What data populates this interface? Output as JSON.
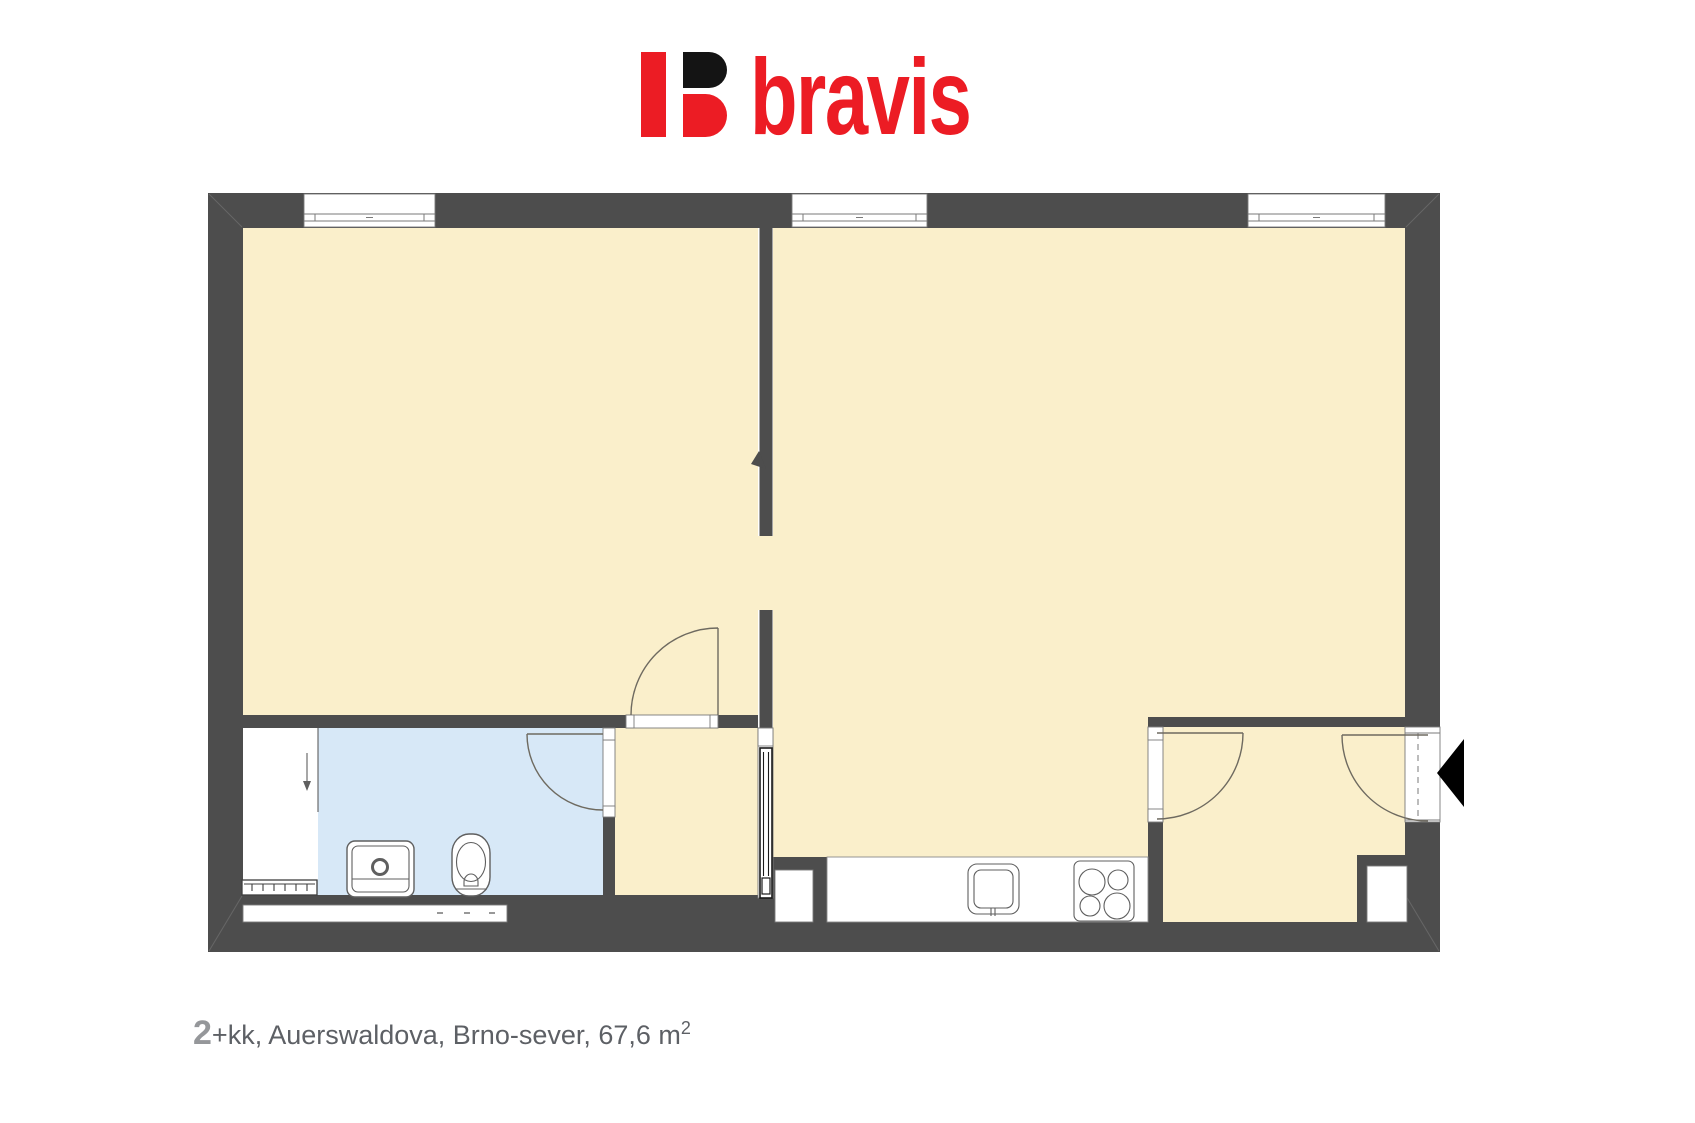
{
  "brand": {
    "name": "bravis"
  },
  "caption": {
    "number": "2",
    "rest": "+kk, Auerswaldova, Brno-sever, 67,6 m",
    "superscript": "2"
  },
  "colors": {
    "logo_red": "#ec1c24",
    "logo_black": "#141414",
    "wall": "#4d4d4d",
    "room_cream": "#faefcb",
    "bathroom_blue": "#d7e8f7",
    "arc_line": "#6e6a60",
    "fixture_line": "#5f5f5f",
    "window_frame": "#7a7a7a",
    "caption_gray": "#5d6065",
    "caption_number_gray": "#95979a"
  },
  "plan_elements": [
    "window",
    "window",
    "window",
    "living-room-door",
    "bathroom-door",
    "right-room-door",
    "entrance-door",
    "sliding-door",
    "entrance-direction-arrow",
    "washbasin",
    "toilet",
    "radiator",
    "wardrobe-with-arrow",
    "kitchen-counter",
    "kitchen-sink",
    "stove",
    "wall-niche",
    "wall-niche",
    "bottom-wall-window"
  ]
}
